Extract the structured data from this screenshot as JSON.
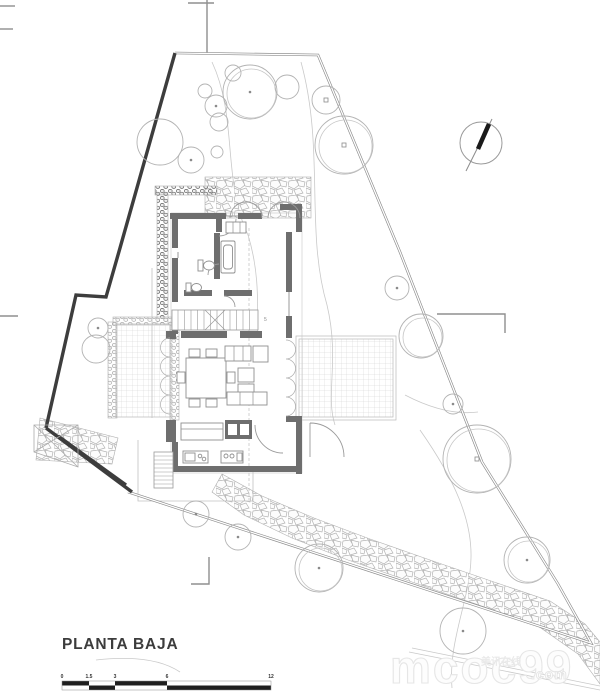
{
  "meta": {
    "drawing_title": "PLANTA BAJA"
  },
  "plan": {
    "stairs_note": "5"
  },
  "scale_bar": {
    "labels": [
      "0",
      "1.5",
      "3",
      "6",
      "12"
    ]
  },
  "watermark": {
    "logo": "mcoc99",
    "cjk": "美讯在线",
    "domain": ".com"
  },
  "colors": {
    "wall_gray": "#6e6e6e",
    "boundary_dark": "#3d3d3d",
    "line_gray": "#9a9a9a",
    "tree_gray": "#b3b3b3",
    "needle_black": "#1a1a1a"
  },
  "site": {
    "trees": [
      {
        "x": 250,
        "y": 92,
        "r": 27,
        "double": true,
        "marker": "dot"
      },
      {
        "x": 287,
        "y": 87,
        "r": 12,
        "double": false,
        "marker": "none"
      },
      {
        "x": 216,
        "y": 106,
        "r": 11,
        "double": false,
        "marker": "dot"
      },
      {
        "x": 219,
        "y": 122,
        "r": 9,
        "double": false,
        "marker": "none"
      },
      {
        "x": 205,
        "y": 91,
        "r": 7,
        "double": false,
        "marker": "none"
      },
      {
        "x": 233,
        "y": 73,
        "r": 8,
        "double": false,
        "marker": "none"
      },
      {
        "x": 160,
        "y": 142,
        "r": 23,
        "double": false,
        "marker": "none"
      },
      {
        "x": 191,
        "y": 160,
        "r": 13,
        "double": false,
        "marker": "dot"
      },
      {
        "x": 217,
        "y": 152,
        "r": 6,
        "double": false,
        "marker": "none"
      },
      {
        "x": 326,
        "y": 100,
        "r": 14,
        "double": false,
        "marker": "square"
      },
      {
        "x": 344,
        "y": 145,
        "r": 29,
        "double": true,
        "marker": "square"
      },
      {
        "x": 98,
        "y": 328,
        "r": 10,
        "double": false,
        "marker": "dot"
      },
      {
        "x": 96,
        "y": 349,
        "r": 14,
        "double": false,
        "marker": "none"
      },
      {
        "x": 397,
        "y": 288,
        "r": 12,
        "double": false,
        "marker": "dot"
      },
      {
        "x": 421,
        "y": 336,
        "r": 22,
        "double": true,
        "marker": "none"
      },
      {
        "x": 453,
        "y": 404,
        "r": 10,
        "double": false,
        "marker": "dot"
      },
      {
        "x": 477,
        "y": 459,
        "r": 34,
        "double": true,
        "marker": "square"
      },
      {
        "x": 527,
        "y": 560,
        "r": 23,
        "double": true,
        "marker": "dot"
      },
      {
        "x": 463,
        "y": 631,
        "r": 23,
        "double": false,
        "marker": "dot"
      },
      {
        "x": 196,
        "y": 514,
        "r": 13,
        "double": false,
        "marker": "dot"
      },
      {
        "x": 238,
        "y": 537,
        "r": 13,
        "double": false,
        "marker": "dot"
      },
      {
        "x": 319,
        "y": 568,
        "r": 24,
        "double": true,
        "marker": "dot"
      }
    ]
  }
}
